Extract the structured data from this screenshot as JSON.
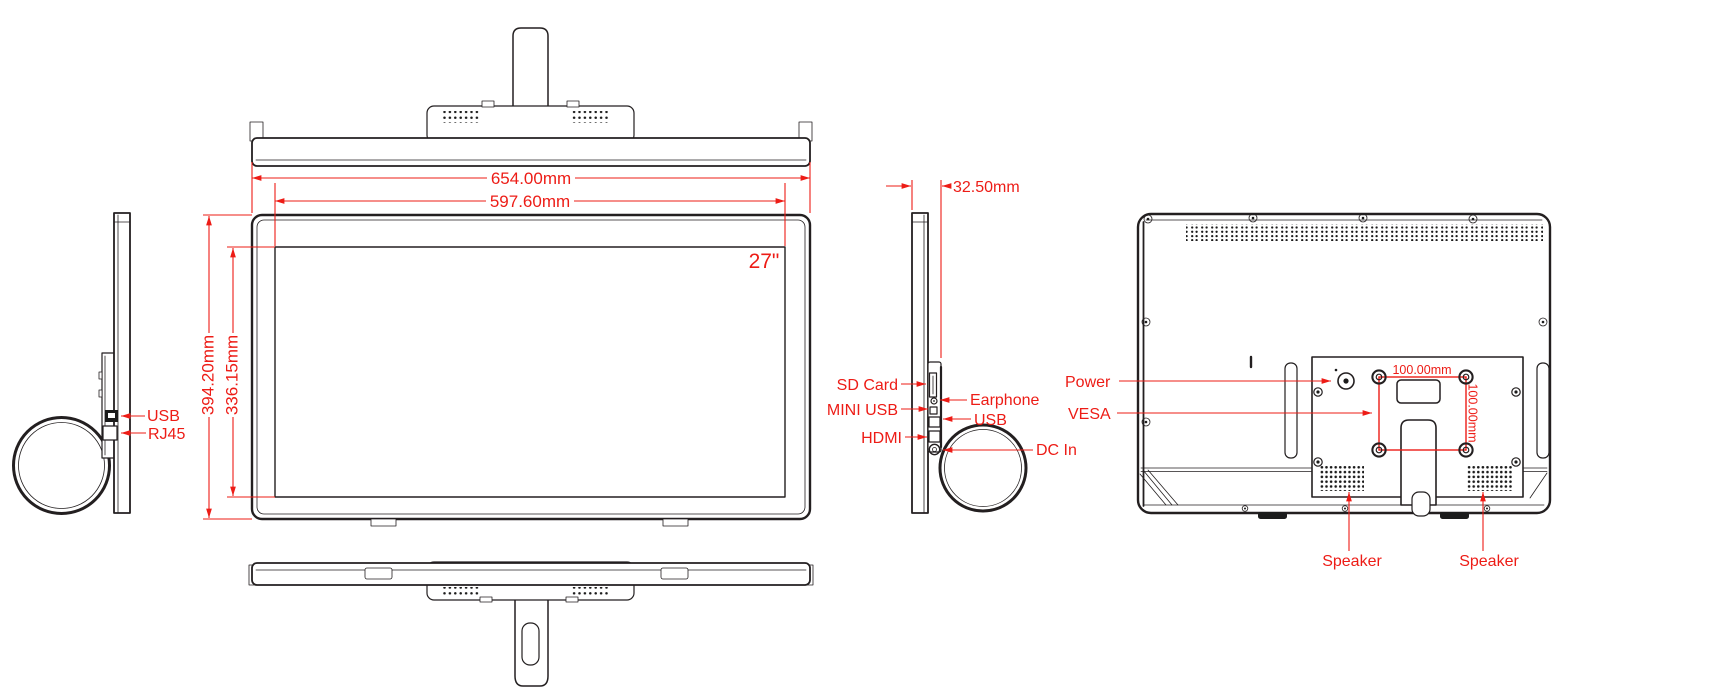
{
  "drawing": {
    "subject": "27 inch all-in-one monitor dimensional drawing",
    "colors": {
      "annotation": "#ed1c16",
      "line": "#231f20",
      "background": "#ffffff"
    }
  },
  "front": {
    "screen_size": "27\"",
    "width_outer": "654.00mm",
    "width_screen": "597.60mm",
    "height_outer": "394.20mm",
    "height_screen": "336.15mm"
  },
  "left_side": {
    "usb": "USB",
    "rj45": "RJ45"
  },
  "right_side": {
    "thickness": "32.50mm",
    "sd_card": "SD Card",
    "mini_usb": "MINI USB",
    "hdmi": "HDMI",
    "earphone": "Earphone",
    "usb": "USB",
    "dc_in": "DC In"
  },
  "back": {
    "power": "Power",
    "vesa": "VESA",
    "vesa_width": "100.00mm",
    "vesa_height": "100.00mm",
    "speaker_left": "Speaker",
    "speaker_right": "Speaker"
  }
}
